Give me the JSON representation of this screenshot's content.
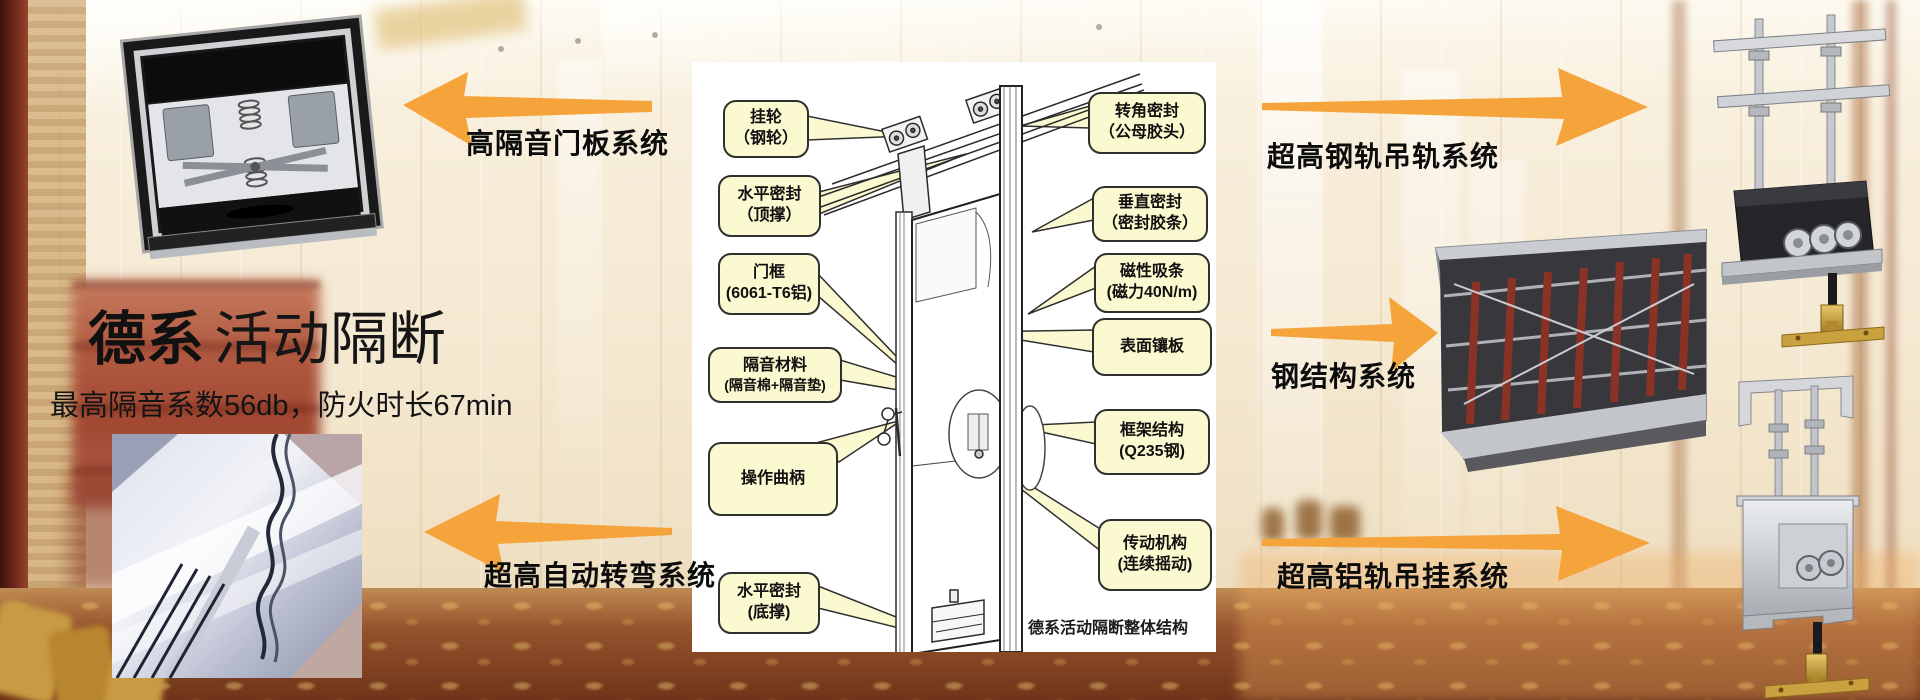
{
  "title": {
    "bold": "德系",
    "regular": "活动隔断",
    "subtitle": "最高隔音系数56db，防火时长67min"
  },
  "systems": {
    "door_panel": "高隔音门板系统",
    "auto_turn": "超高自动转弯系统",
    "steel_rail": "超高钢轨吊轨系统",
    "steel_structure": "钢结构系统",
    "alu_rail": "超高铝轨吊挂系统"
  },
  "diagram": {
    "caption": "德系活动隔断整体结构",
    "labels_left": [
      {
        "l1": "挂轮",
        "l2": "（钢轮）"
      },
      {
        "l1": "水平密封",
        "l2": "（顶撑）"
      },
      {
        "l1": "门框",
        "l2": "(6061-T6铝)"
      },
      {
        "l1": "隔音材料",
        "l2": "(隔音棉+隔音垫)"
      },
      {
        "l1": "操作曲柄",
        "l2": ""
      },
      {
        "l1": "水平密封",
        "l2": "(底撑)"
      }
    ],
    "labels_right": [
      {
        "l1": "转角密封",
        "l2": "（公母胶头）"
      },
      {
        "l1": "垂直密封",
        "l2": "（密封胶条）"
      },
      {
        "l1": "磁性吸条",
        "l2": "(磁力40N/m)"
      },
      {
        "l1": "表面镶板",
        "l2": ""
      },
      {
        "l1": "框架结构",
        "l2": "(Q235钢)"
      },
      {
        "l1": "传动机构",
        "l2": "(连续摇动)"
      }
    ]
  },
  "colors": {
    "accent_orange": "#F5A43C",
    "callout_yellow": "#FBF9CF",
    "panel_white": "#FFFFFF"
  }
}
